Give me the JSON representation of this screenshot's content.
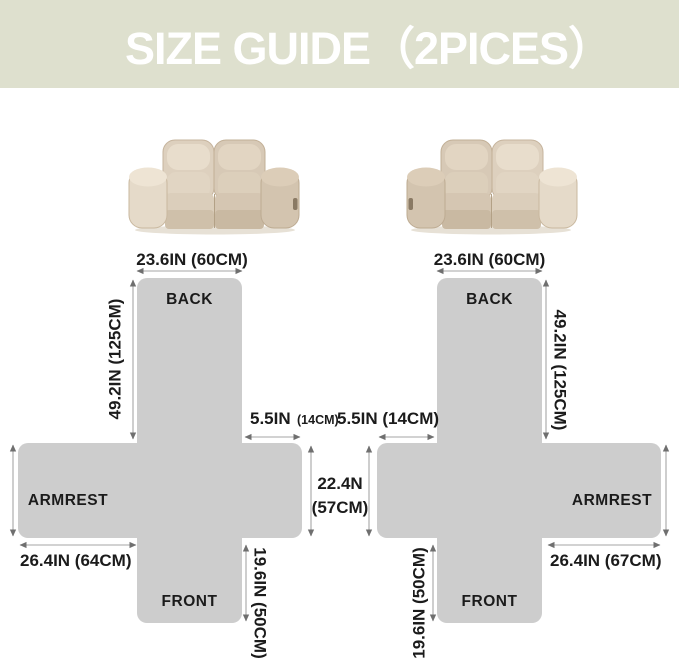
{
  "header": {
    "title": "SIZE GUIDE（2PICES）",
    "bg_color": "#dee0ce",
    "text_color": "#ffffff"
  },
  "colors": {
    "shape_fill": "#cdcdcd",
    "dimension_line": "#a6a6a6",
    "arrowhead": "#6f6f6f",
    "label_text": "#1b1b1b",
    "sofa_beige": "#d9cbb8"
  },
  "left_diagram": {
    "back_label": "BACK",
    "armrest_label": "ARMREST",
    "front_label": "FRONT",
    "top_width": "23.6IN (60CM)",
    "back_height": "49.2IN (125CM)",
    "shoulder_in": "5.5IN",
    "shoulder_cm": "(14CM)",
    "armrest_length": "26.4IN (64CM)",
    "front_height": "19.6IN (50CM)"
  },
  "middle_dim": {
    "seat_height_line1": "22.4N",
    "seat_height_line2": "(57CM)"
  },
  "right_diagram": {
    "back_label": "BACK",
    "armrest_label": "ARMREST",
    "front_label": "FRONT",
    "top_width": "23.6IN (60CM)",
    "back_height": "49.2IN (125CM)",
    "shoulder": "5.5IN (14CM)",
    "armrest_length": "26.4IN (67CM)",
    "front_height": "19.6IN (50CM)"
  }
}
